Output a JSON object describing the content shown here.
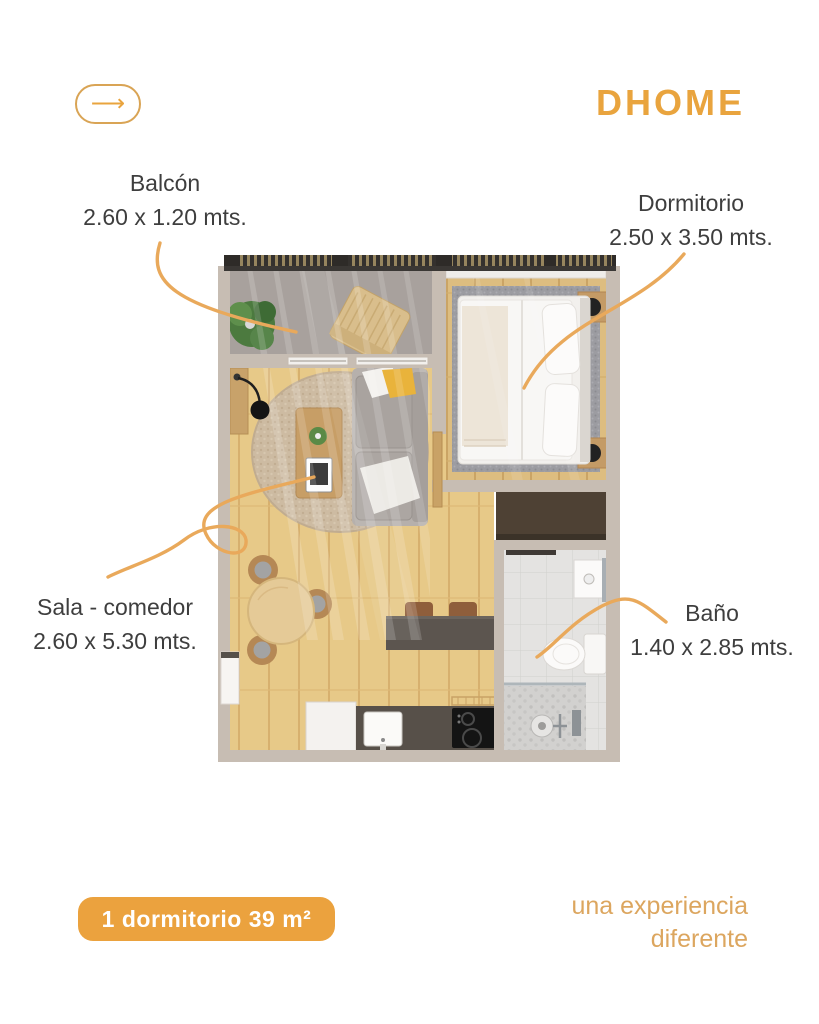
{
  "header": {
    "logo": "DHOME",
    "back_arrow": "⟶"
  },
  "plan": {
    "type": "apartment-floor-plan",
    "rooms": [
      {
        "id": "balcon",
        "name": "Balcón",
        "dimensions": "2.60 x 1.20 mts."
      },
      {
        "id": "dormitorio",
        "name": "Dormitorio",
        "dimensions": "2.50 x 3.50 mts."
      },
      {
        "id": "sala",
        "name": "Sala - comedor",
        "dimensions": "2.60 x 5.30 mts."
      },
      {
        "id": "bano",
        "name": "Baño",
        "dimensions": "1.40 x 2.85 mts."
      }
    ]
  },
  "footer": {
    "badge": "1 dormitorio 39 m²",
    "tagline": [
      "una experiencia",
      "diferente"
    ]
  },
  "colors": {
    "accent": "#e9a43e",
    "badge_bg": "#eba23e",
    "tagline": "#dca65f",
    "label_text": "#3e3e3e",
    "leader_line": "#e9a95b",
    "wall": "#c7bdb3",
    "wood_floor": "#e7c988",
    "balcony_floor": "#a8a19d"
  }
}
